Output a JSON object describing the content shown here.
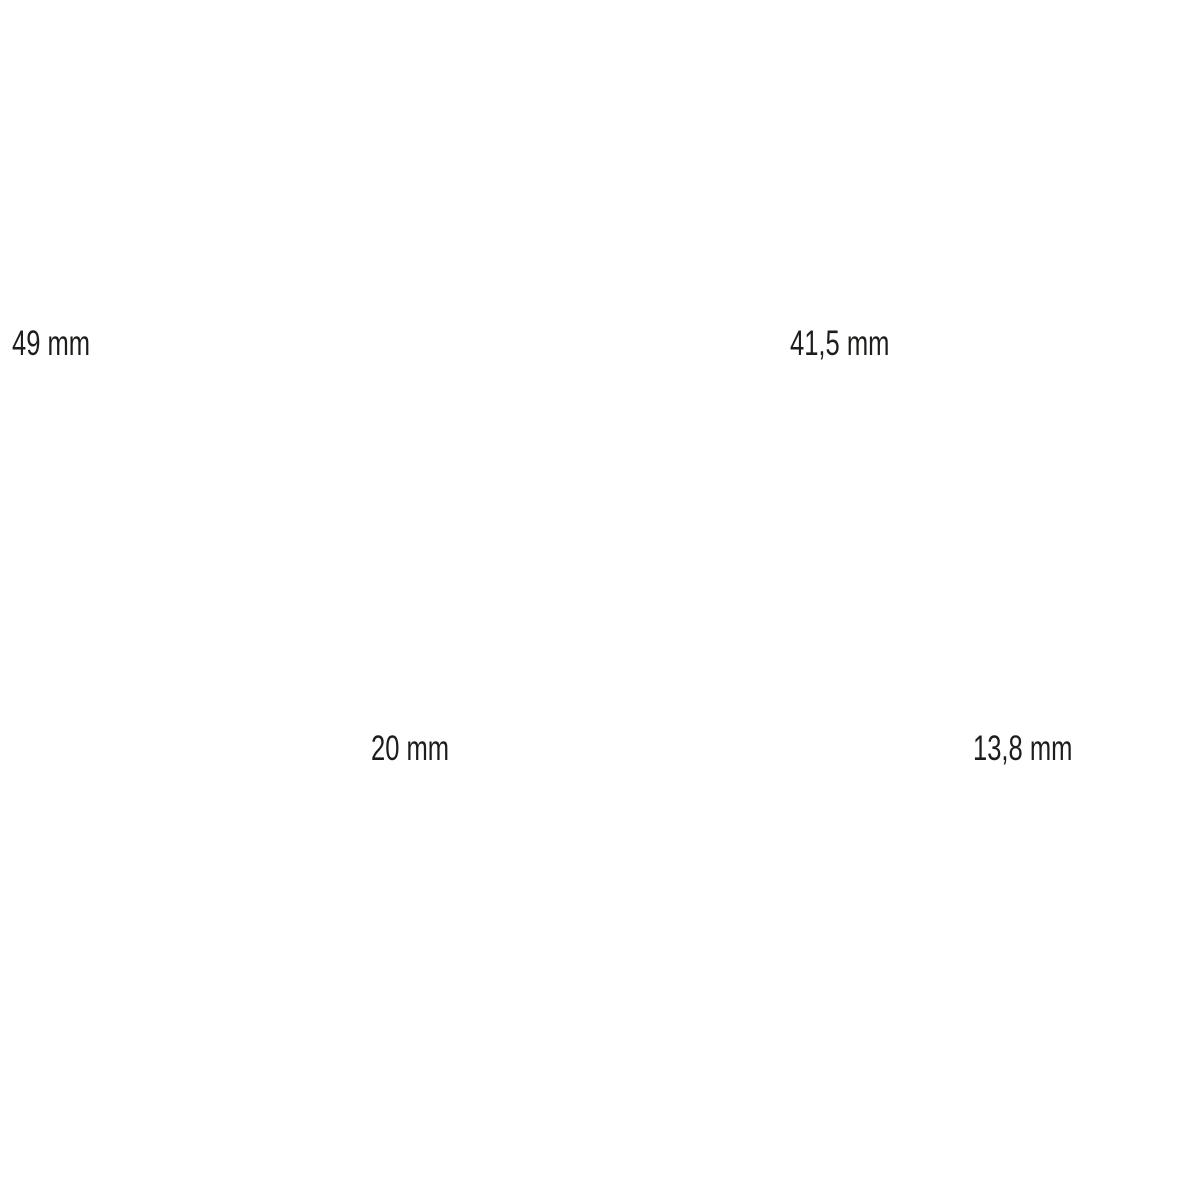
{
  "canvas": {
    "background": "#ffffff",
    "text_color": "#1d1d1b"
  },
  "dimension_labels": [
    {
      "position": "top-left",
      "value": "49 mm"
    },
    {
      "position": "top-right",
      "value": "41,5 mm"
    },
    {
      "position": "bottom-center",
      "value": "20 mm"
    },
    {
      "position": "bottom-right",
      "value": "13,8 mm"
    }
  ]
}
